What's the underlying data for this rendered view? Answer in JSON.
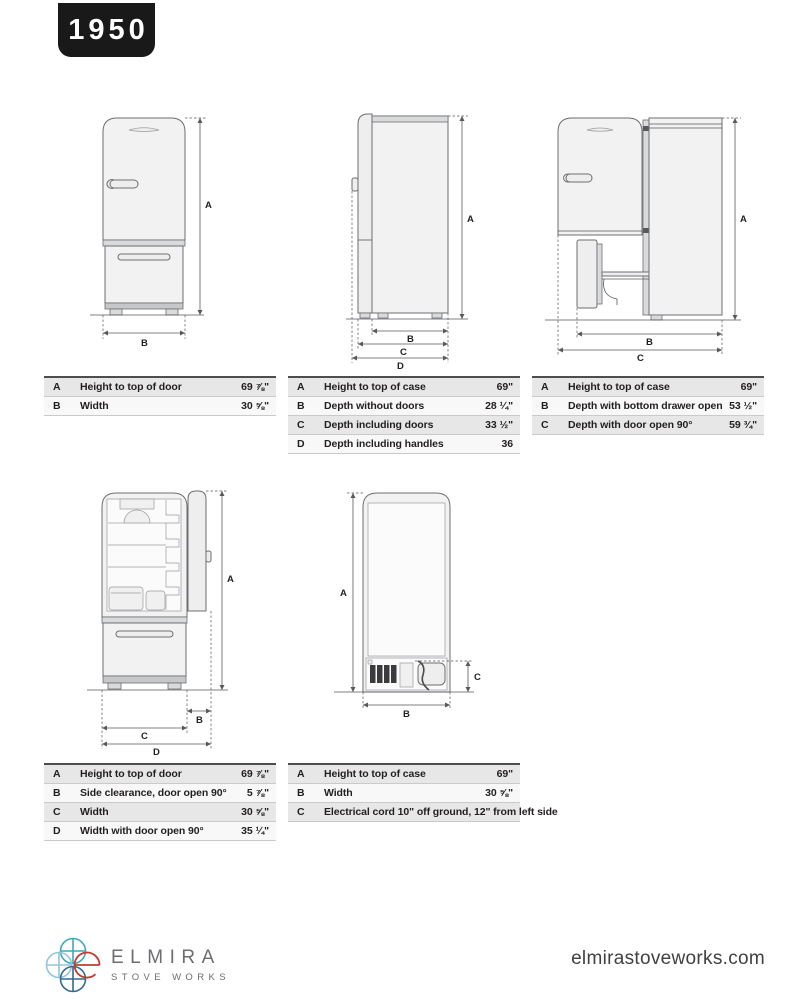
{
  "page": {
    "model": "1950",
    "website": "elmirastoveworks.com"
  },
  "logo": {
    "name": "ELMIRA",
    "subname": "STOVE WORKS"
  },
  "figures": [
    {
      "name": "front-view",
      "dims": [
        "A",
        "B"
      ]
    },
    {
      "name": "side-view",
      "dims": [
        "A",
        "B",
        "C",
        "D"
      ]
    },
    {
      "name": "side-view-open",
      "dims": [
        "A",
        "B",
        "C"
      ]
    },
    {
      "name": "front-view-door-open",
      "dims": [
        "A",
        "B",
        "C",
        "D"
      ]
    },
    {
      "name": "back-view",
      "dims": [
        "A",
        "B",
        "C"
      ]
    }
  ],
  "tables": [
    {
      "rows": [
        {
          "key": "A",
          "label": "Height to top of door",
          "value": "69 ⅞\""
        },
        {
          "key": "B",
          "label": "Width",
          "value": "30 ⅝\""
        }
      ]
    },
    {
      "rows": [
        {
          "key": "A",
          "label": "Height to top of case",
          "value": "69\""
        },
        {
          "key": "B",
          "label": "Depth without doors",
          "value": "28 ¼\""
        },
        {
          "key": "C",
          "label": "Depth including doors",
          "value": "33 ½\""
        },
        {
          "key": "D",
          "label": "Depth including handles",
          "value": "36"
        }
      ]
    },
    {
      "rows": [
        {
          "key": "A",
          "label": "Height to top of case",
          "value": "69\""
        },
        {
          "key": "B",
          "label": "Depth with bottom drawer open",
          "value": "53 ½\""
        },
        {
          "key": "C",
          "label": "Depth with door open 90°",
          "value": "59 ¾\""
        }
      ]
    },
    {
      "rows": [
        {
          "key": "A",
          "label": "Height to top of door",
          "value": "69 ⅞\""
        },
        {
          "key": "B",
          "label": "Side clearance, door open 90°",
          "value": "5 ⅞\""
        },
        {
          "key": "C",
          "label": "Width",
          "value": "30 ⅝\""
        },
        {
          "key": "D",
          "label": "Width with door open 90°",
          "value": "35 ¼\""
        }
      ]
    },
    {
      "rows": [
        {
          "key": "A",
          "label": "Height to top of case",
          "value": "69\""
        },
        {
          "key": "B",
          "label": "Width",
          "value": "30 ⅝\""
        },
        {
          "key": "C",
          "label": "Electrical cord 10\" off ground, 12\" from left side",
          "value": ""
        }
      ]
    }
  ]
}
